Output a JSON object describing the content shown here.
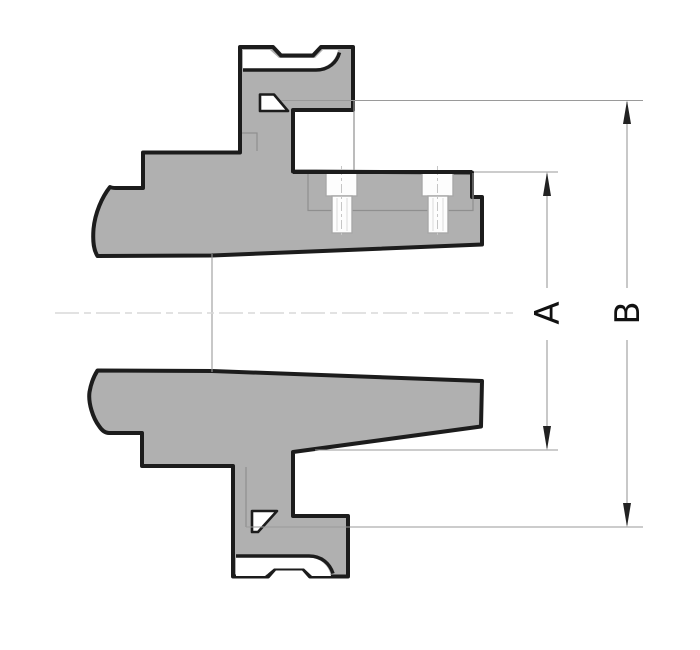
{
  "diagram": {
    "type": "technical-cross-section",
    "description": "Sectioned flanged hub with clamp ferrule ends, tapered bore, two threaded studs, and two diameter dimensions",
    "dimensions": {
      "a_label": "A",
      "b_label": "B"
    },
    "colors": {
      "background": "#ffffff",
      "body_fill": "#b0b0b0",
      "outline": "#1c1c1c",
      "groove_fill": "#ffffff",
      "detail_line": "#8f8f8f",
      "dimension_line": "#9a9a9a",
      "arrow": "#222222",
      "centerline": "#d8d8d8",
      "stud_outline": "#a8a8a8",
      "stud_fill": "#fdfdfd"
    }
  }
}
